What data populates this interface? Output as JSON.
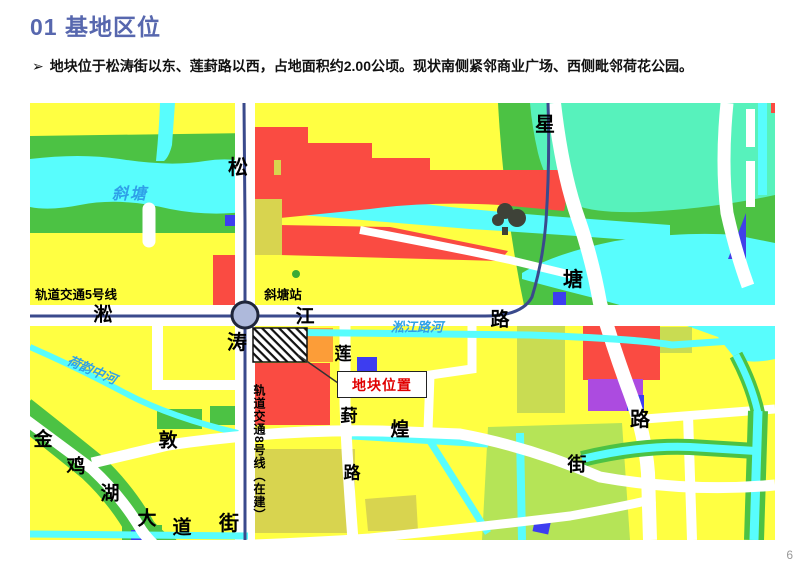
{
  "slide": {
    "title": "01 基地区位",
    "bullet_marker": "➢",
    "bullet_text": "地块位于松涛街以东、莲葑路以西，占地面积约2.00公顷。现状南侧紧邻商业广场、西侧毗邻荷花公园。",
    "page_number": "6"
  },
  "map": {
    "road_names": {
      "songtao_street": [
        "松",
        "涛",
        "街"
      ],
      "xingtang_road": [
        "星",
        "塘",
        "路"
      ],
      "songjiang_road": [
        "淞",
        "江",
        "路"
      ],
      "lianfeng_road": [
        "莲",
        "葑",
        "路"
      ],
      "jinjihu_avenue": [
        "金",
        "鸡",
        "湖",
        "大",
        "道"
      ],
      "dunhuang_street": [
        "敦",
        "煌",
        "街"
      ]
    },
    "rail_labels": {
      "line5": "轨道交通5号线",
      "line8": "轨道交通8号线（在建）",
      "station": "斜塘站"
    },
    "water_labels": {
      "xietang": "斜塘",
      "songjiang_river": "淞江路河",
      "heyun_river": "荷韵中河"
    },
    "site_callout": "地块位置",
    "colors": {
      "title_blue": "#5767AE",
      "land_yellow": "#FFFF42",
      "green_space": "#4CC244",
      "water_cyan": "#58FDFD",
      "park_teal": "#57F2BC",
      "commercial_red": "#FA4B42",
      "orange_parcel": "#FC9D38",
      "blue_parcel": "#3D3DF0",
      "purple_parcel": "#AC4BE0",
      "olive_parcel": "#D8D44F",
      "lightgreen_parcel": "#B5E457",
      "rail_navy": "#3A4A8C",
      "site_label_red": "#E00000"
    }
  }
}
